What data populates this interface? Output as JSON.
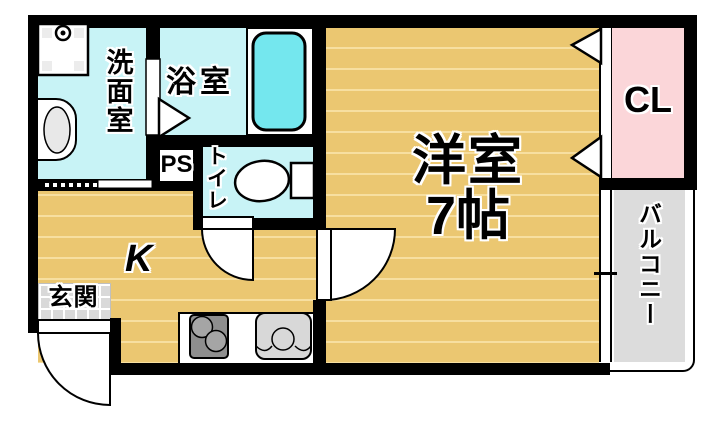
{
  "floorplan": {
    "type": "apartment-floor-plan-1K",
    "rooms": {
      "washroom": {
        "label": "洗面室"
      },
      "bath": {
        "label": "浴室"
      },
      "pipe_space": {
        "label": "PS"
      },
      "toilet": {
        "label": "トイレ"
      },
      "kitchen": {
        "label": "K"
      },
      "entrance": {
        "label": "玄関"
      },
      "western_room": {
        "label": "洋室",
        "size": "7帖"
      },
      "closet": {
        "label": "CL"
      },
      "balcony": {
        "label": "バルコニー"
      }
    },
    "fixtures": [
      "washing-machine-pan",
      "wash-basin",
      "bathtub",
      "toilet-bowl",
      "gas-stove",
      "kitchen-sink",
      "entrance-door",
      "toilet-door",
      "room-door",
      "bath-folding-door",
      "closet-folding-doors",
      "balcony-sliding-window"
    ],
    "colors": {
      "wall": "#000000",
      "wood_floor": "#ebc771",
      "wood_stripe": "#f7dfa0",
      "wet_room": "#c8f3f6",
      "bathtub": "#74e7ee",
      "closet": "#fbd6d9",
      "balcony": "#dcdcdc",
      "entrance_tile": "#d9d9d9"
    }
  }
}
